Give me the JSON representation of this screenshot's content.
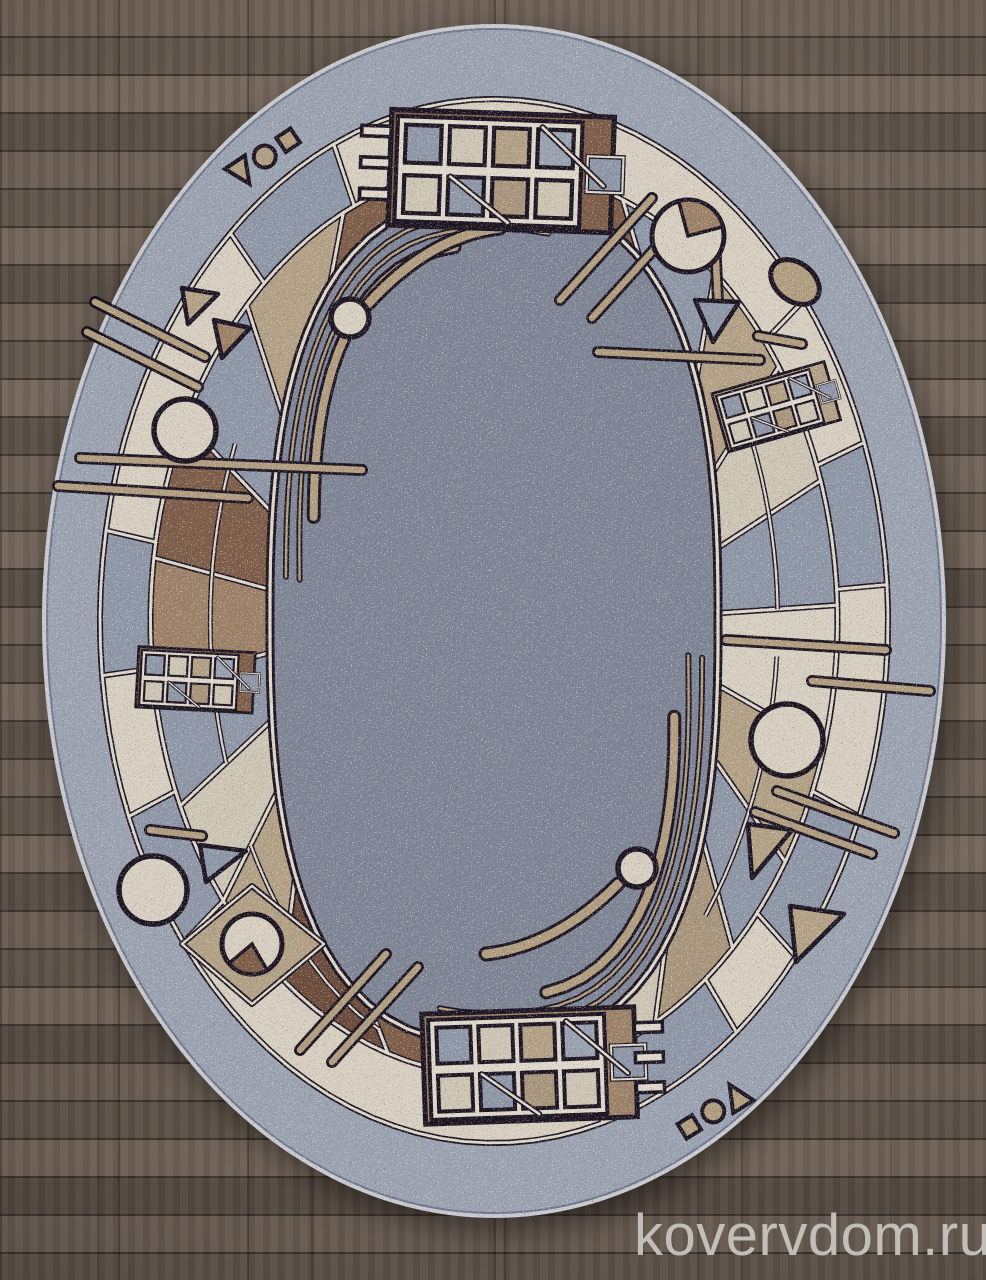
{
  "watermark": {
    "text": "kovervdom.ru",
    "color": "#c9c7c3"
  },
  "floor": {
    "base_color": "#6a5c51",
    "seam_color": "#41372f"
  },
  "rug": {
    "cx": 494,
    "cy": 621,
    "bands": {
      "binding": [
        452,
        597
      ],
      "outer": [
        447,
        592
      ],
      "band": [
        394,
        522
      ],
      "panel": [
        343.5,
        454.5
      ]
    },
    "field": {
      "a": 224,
      "b": 422,
      "n": 2.6
    },
    "palette": {
      "field": "#7d8494",
      "outerBand": "#9aa2b0",
      "binding": "#c6c9cf",
      "edge": "#70778a",
      "cream": "#d6cfc0",
      "cream2": "#cdc5b3",
      "gray": "#8d96a6",
      "gray2": "#98a1af",
      "tan": "#b2a084",
      "tan2": "#a8947a",
      "ltbrown": "#9c8066",
      "brown": "#7d5c47",
      "darkbrown": "#6a4a39",
      "outline": "#1b1420",
      "lineCream": "#ded8cb",
      "stick": "#b09c7e",
      "wedge": "#8d6f52"
    },
    "bandCells": [
      {
        "f": 336,
        "t": 412,
        "c": "cream"
      },
      {
        "f": 52,
        "t": 70,
        "c": "cream"
      },
      {
        "f": 70,
        "t": 86,
        "c": "gray"
      },
      {
        "f": 86,
        "t": 112,
        "c": "cream"
      },
      {
        "f": 112,
        "t": 130,
        "c": "gray"
      },
      {
        "f": 130,
        "t": 142,
        "c": "cream"
      },
      {
        "f": 142,
        "t": 164,
        "c": "gray"
      },
      {
        "f": 164,
        "t": 232,
        "c": "cream"
      },
      {
        "f": 232,
        "t": 248,
        "c": "gray"
      },
      {
        "f": 248,
        "t": 264,
        "c": "cream"
      },
      {
        "f": 264,
        "t": 280,
        "c": "gray"
      },
      {
        "f": 280,
        "t": 318,
        "c": "cream"
      },
      {
        "f": 318,
        "t": 336,
        "c": "gray"
      }
    ],
    "panelCells": [
      {
        "f": -26,
        "t": 22,
        "c": "brown"
      },
      {
        "f": 22,
        "t": 40,
        "c": "gray"
      },
      {
        "f": 40,
        "t": 56,
        "c": "tan"
      },
      {
        "f": 56,
        "t": 72,
        "c": "cream2"
      },
      {
        "f": 72,
        "t": 88,
        "c": "gray"
      },
      {
        "f": 88,
        "t": 106,
        "c": "cream"
      },
      {
        "f": 106,
        "t": 122,
        "c": "tan"
      },
      {
        "f": 122,
        "t": 136,
        "c": "gray"
      },
      {
        "f": 136,
        "t": 152,
        "c": "tan2"
      },
      {
        "f": 152,
        "t": 168,
        "c": "cream2"
      },
      {
        "f": 168,
        "t": 198,
        "c": "brown"
      },
      {
        "f": 198,
        "t": 218,
        "c": "darkbrown"
      },
      {
        "f": 218,
        "t": 232,
        "c": "tan"
      },
      {
        "f": 232,
        "t": 246,
        "c": "cream2"
      },
      {
        "f": 246,
        "t": 262,
        "c": "gray"
      },
      {
        "f": 262,
        "t": 278,
        "c": "ltbrown"
      },
      {
        "f": 278,
        "t": 296,
        "c": "brown"
      },
      {
        "f": 296,
        "t": 314,
        "c": "gray"
      },
      {
        "f": 314,
        "t": 334,
        "c": "tan"
      }
    ],
    "sublines": [
      {
        "f": 56,
        "t": 88
      },
      {
        "f": 96,
        "t": 140
      },
      {
        "f": 198,
        "t": 232
      },
      {
        "f": 246,
        "t": 300
      }
    ],
    "fieldArcs": [
      {
        "from": 282,
        "to": 368,
        "offs": [
          16,
          30
        ]
      },
      {
        "from": 100,
        "to": 188,
        "offs": [
          16,
          30
        ]
      }
    ],
    "thickInsetArcs": [
      {
        "from": 300,
        "to": 354,
        "off": 46,
        "w": 8
      },
      {
        "from": 118,
        "to": 172,
        "off": 46,
        "w": 8
      }
    ],
    "thickArcs": [
      "M368 304Q430 236 500 228",
      "M618 884Q556 946 486 954"
    ],
    "sticks": [
      [
        560,
        300,
        652,
        198
      ],
      [
        592,
        318,
        686,
        214
      ],
      [
        80,
        458,
        362,
        470
      ],
      [
        58,
        486,
        248,
        498
      ],
      [
        755,
        812,
        872,
        854
      ],
      [
        777,
        791,
        894,
        833
      ],
      [
        726,
        640,
        886,
        650
      ],
      [
        812,
        681,
        930,
        691
      ],
      [
        300,
        1050,
        386,
        954
      ],
      [
        332,
        1062,
        418,
        967
      ],
      [
        95,
        302,
        205,
        357
      ],
      [
        87,
        332,
        198,
        387
      ],
      [
        598,
        352,
        760,
        360
      ],
      [
        714,
        222,
        718,
        302
      ],
      [
        758,
        336,
        802,
        344
      ],
      [
        150,
        830,
        202,
        836
      ]
    ],
    "circles": [
      [
        185,
        430,
        31
      ],
      [
        153,
        890,
        34
      ],
      [
        350,
        318,
        19
      ],
      [
        637,
        868,
        19
      ],
      [
        787,
        740,
        36
      ]
    ],
    "pacs": [
      {
        "x": 688,
        "y": 236,
        "r": 36,
        "a1": -15,
        "a2": 75,
        "c": "ltbrown"
      },
      {
        "x": 252,
        "y": 944,
        "r": 30,
        "a1": 150,
        "a2": 230,
        "c": "brown"
      }
    ],
    "diamonds": [
      [
        [
          252,
          886
        ],
        [
          324,
          944
        ],
        [
          252,
          1004
        ],
        [
          182,
          944
        ]
      ]
    ],
    "triangles": [
      {
        "p": [
          [
            695,
            300
          ],
          [
            739,
            302
          ],
          [
            713,
            342
          ]
        ],
        "c": "gray"
      },
      {
        "p": [
          [
            748,
            824
          ],
          [
            792,
            830
          ],
          [
            752,
            878
          ]
        ],
        "c": "tan"
      },
      {
        "p": [
          [
            790,
            906
          ],
          [
            844,
            914
          ],
          [
            796,
            962
          ]
        ],
        "c": "tan"
      },
      {
        "p": [
          [
            182,
            288
          ],
          [
            218,
            294
          ],
          [
            188,
            324
          ]
        ],
        "c": "tan"
      },
      {
        "p": [
          [
            214,
            320
          ],
          [
            250,
            328
          ],
          [
            222,
            358
          ]
        ],
        "c": "ltbrown"
      },
      {
        "p": [
          [
            200,
            845
          ],
          [
            246,
            851
          ],
          [
            206,
            882
          ]
        ],
        "c": "gray"
      }
    ],
    "trios": [
      {
        "x": 262,
        "y": 156,
        "rot": -34
      },
      {
        "x": 716,
        "y": 1112,
        "rot": 148
      }
    ],
    "ellipses": [
      {
        "x": 795,
        "y": 282,
        "rx": 27,
        "ry": 19,
        "rot": 38
      }
    ],
    "grids": [
      {
        "x": 398,
        "y": 116,
        "s": 1.05,
        "rot": 2,
        "bg": "brown",
        "comb": "left"
      },
      {
        "x": 716,
        "y": 396,
        "s": 0.55,
        "rot": -16,
        "bg": "tan",
        "comb": "none"
      },
      {
        "x": 428,
        "y": 1020,
        "s": 1.0,
        "rot": -2,
        "bg": "ltbrown",
        "comb": "right"
      },
      {
        "x": 142,
        "y": 650,
        "s": 0.55,
        "rot": 3,
        "bg": "brown",
        "comb": "none"
      }
    ]
  }
}
